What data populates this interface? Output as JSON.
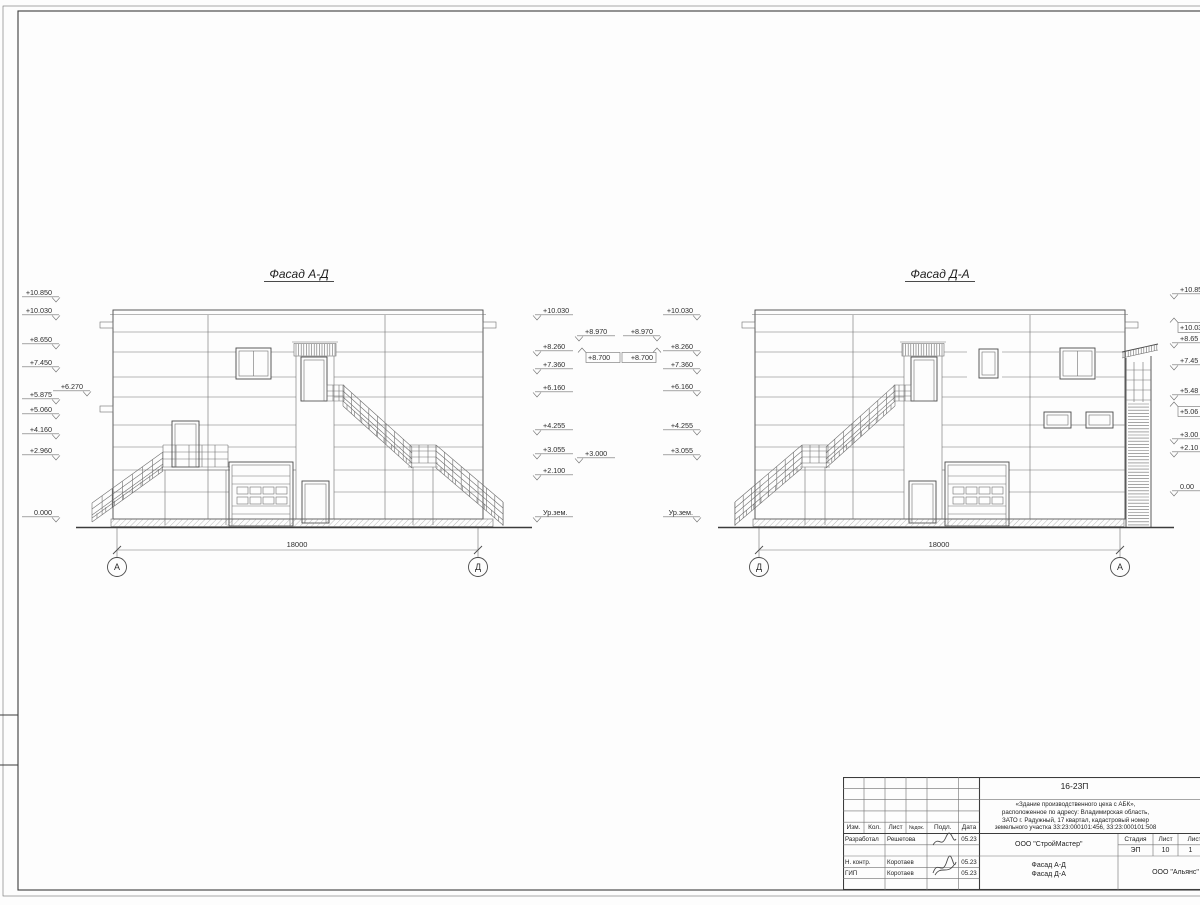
{
  "facades": [
    {
      "title": "Фасад А-Д",
      "dimension": "18000",
      "axes": [
        "А",
        "Д"
      ],
      "marks_left": [
        "+10.850",
        "+10.030",
        "+8.650",
        "+7.450",
        "+5.875",
        "+5.060",
        "+4.160",
        "+2.960",
        "0.000"
      ],
      "mark_left_offset": "+6.270",
      "marks_right": [
        "+10.030",
        "+8.260",
        "+7.360",
        "+6.160",
        "+4.255",
        "+3.055",
        "+2.100",
        "Ур.зем."
      ],
      "marks_right_offset": [
        "+8.970",
        "+8.700",
        "+3.000"
      ]
    },
    {
      "title": "Фасад Д-А",
      "dimension": "18000",
      "axes": [
        "Д",
        "А"
      ],
      "marks_left_offset": [
        "+8.970",
        "+8.700"
      ],
      "marks_left": [
        "+10.030",
        "+8.260",
        "+7.360",
        "+6.160",
        "+4.255",
        "+3.055",
        "Ур.зем."
      ],
      "marks_right": [
        "+10.85",
        "+10.03",
        "+8.65",
        "+7.45",
        "+5.48",
        "+5.06",
        "+3.00",
        "+2.10",
        "0.00"
      ]
    }
  ],
  "title_block": {
    "doc_number": "16-23П",
    "description_lines": [
      "«Здание производственного цеха с АБК»,",
      "расположенное по адресу: Владимирская область,",
      "ЗАТО г. Радужный, 17 квартал, кадастровый номер",
      "земельного участка 33:23:000101:456, 33:23:000101:508"
    ],
    "rev_columns": [
      "Изм.",
      "Кол.",
      "Лист",
      "№док.",
      "Подл.",
      "Дата"
    ],
    "staff": [
      {
        "role": "Разработал",
        "name": "Решетова",
        "date": "05.23"
      },
      {
        "role": "Н. контр.",
        "name": "Коротаев",
        "date": "05.23"
      },
      {
        "role": "ГИП",
        "name": "Коротаев",
        "date": "05.23"
      }
    ],
    "organization": "ООО \"СтройМастер\"",
    "stage_label": "Стадия",
    "sheet_label": "Лист",
    "sheets_label": "Листов",
    "stage": "ЭП",
    "sheet_number": "10",
    "sheets_total": "1",
    "drawing_title_lines": [
      "Фасад А-Д",
      "Фасад Д-А"
    ],
    "contractor": "ООО \"Альянс\""
  }
}
